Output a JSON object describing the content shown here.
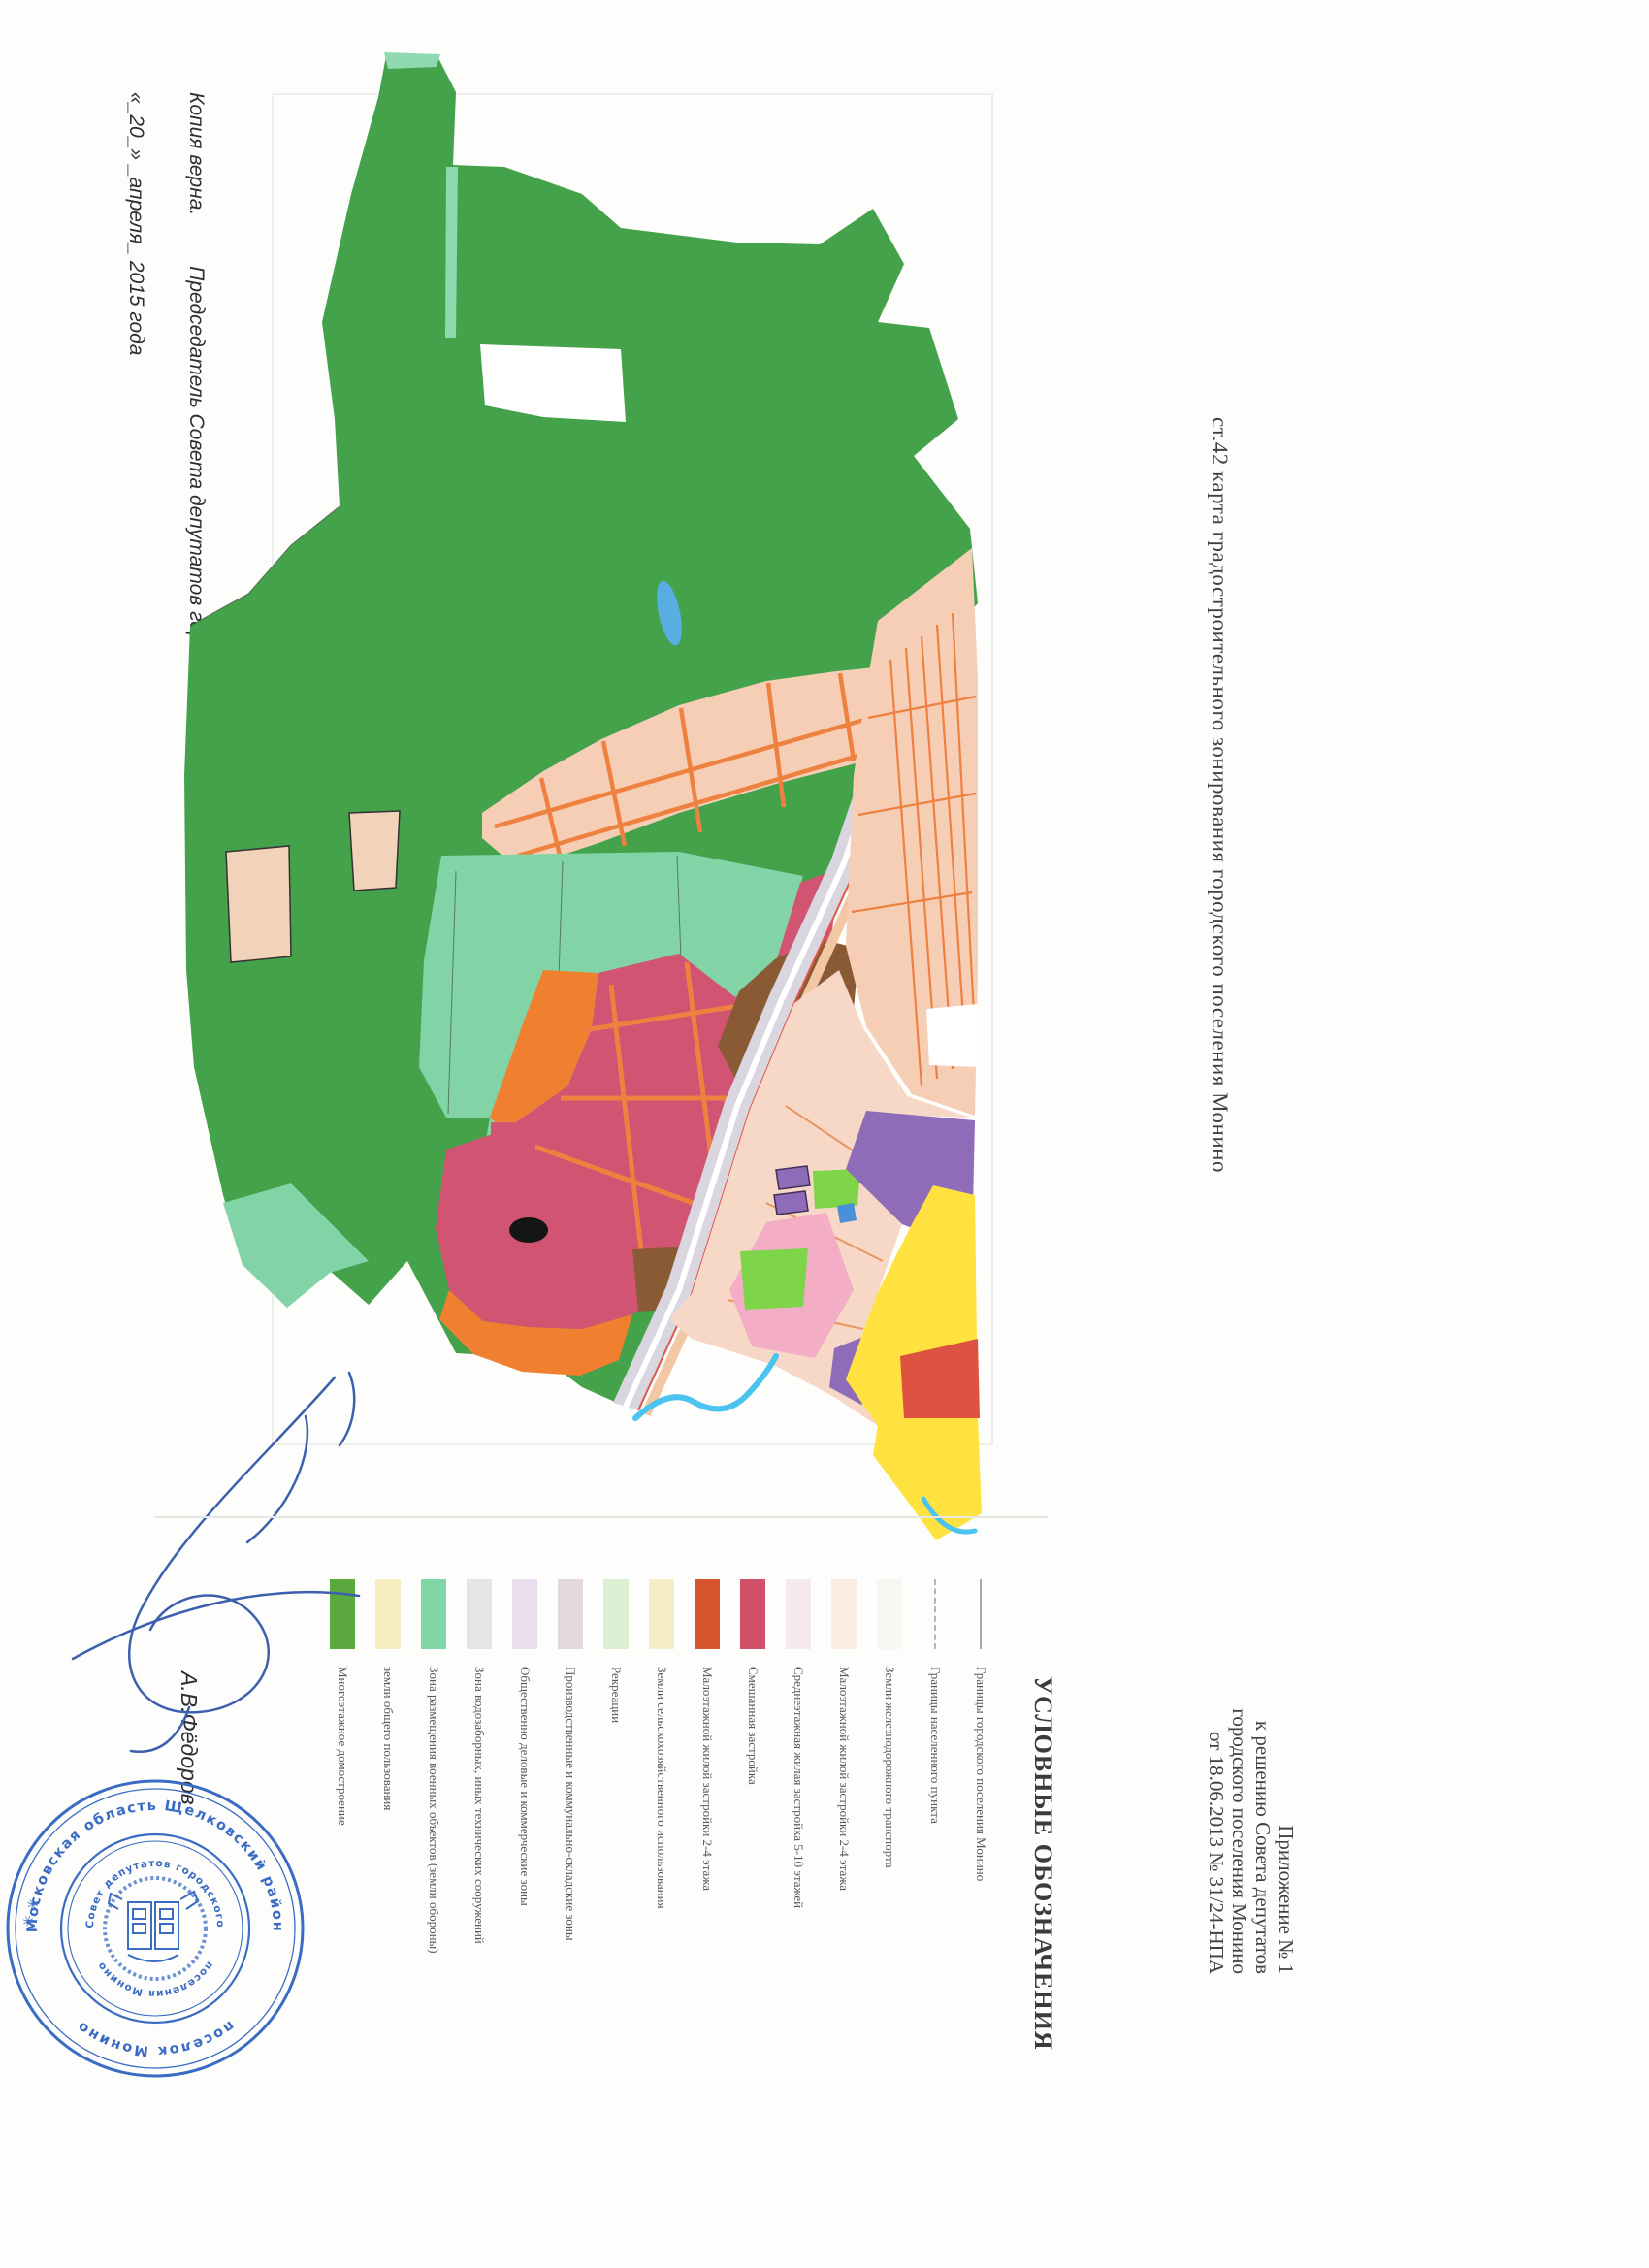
{
  "page": {
    "appendix": {
      "lines": [
        "Приложение № 1",
        "к решению Совета депутатов",
        "городского поселения Монино",
        "от 18.06.2013 № 31/24-НПА"
      ]
    },
    "map_title": "ст.42 карта градостроительного зонирования городского поселения Монино",
    "legend": {
      "title": "УСЛОВНЫЕ ОБОЗНАЧЕНИЯ",
      "items": [
        {
          "label": "Границы городского поселения Монино",
          "symbol": "boundary-line",
          "color": null
        },
        {
          "label": "Границы населенного пункта",
          "symbol": "boundary-dashed",
          "color": null
        },
        {
          "label": "Земли железнодорожного транспорта",
          "symbol": "swatch",
          "color": "#f7f6f3"
        },
        {
          "label": "Малоэтажной жилой застройки 2-4 этажа",
          "symbol": "swatch",
          "color": "#fbece4"
        },
        {
          "label": "Среднеэтажная жилая застройка 5-10 этажей",
          "symbol": "swatch",
          "color": "#f5e9ee"
        },
        {
          "label": "Смешанная застройка",
          "symbol": "swatch",
          "color": "#d05168"
        },
        {
          "label": "Малоэтажной жилой застройки 2-4 этажа",
          "symbol": "swatch",
          "color": "#d8542e"
        },
        {
          "label": "Земли сельскохозяйственного использования",
          "symbol": "swatch",
          "color": "#f5edc6"
        },
        {
          "label": "Рекреации",
          "symbol": "swatch",
          "color": "#dcefd2"
        },
        {
          "label": "Производственные и коммунально-складские зоны",
          "symbol": "swatch",
          "color": "#e5d8dc"
        },
        {
          "label": "Общественно деловые и коммерческие зоны",
          "symbol": "swatch",
          "color": "#e8deec"
        },
        {
          "label": "Зона водозаборных, иных технических сооружений",
          "symbol": "swatch",
          "color": "#e4e5e7"
        },
        {
          "label": "Зона размещения военных объектов (земли обороны)",
          "symbol": "swatch",
          "color": "#82d6a6"
        },
        {
          "label": "земли общего пользования",
          "symbol": "swatch",
          "color": "#f6ecbf"
        },
        {
          "label": "Многоэтажное домостроение",
          "symbol": "swatch",
          "color": "#5aa83e"
        }
      ]
    },
    "certification": {
      "copy_note": "Копия верна.",
      "position": "Председатель Совета депутатов городского поселения Монино",
      "date": "«_20_» _апреля_ 2015 года",
      "name": "А.В.Фёдоров"
    },
    "stamp": {
      "outer_top": "Московская область Щелковский район",
      "outer_bottom": "поселок Монино",
      "inner_top": "Совет депутатов городского",
      "inner_bottom": "поселения Монино",
      "stars": "✳ ✳",
      "color": "#3a6cc4"
    },
    "signature_ink": "#3c5fae",
    "map": {
      "colors": {
        "forest": "#43a24a",
        "seagreen": "#82d4a6",
        "seagreen_light": "#8fd8b0",
        "peach": "#f6ceb6",
        "street": "#ee8040",
        "crimson": "#d15472",
        "orange": "#f08030",
        "brown": "#8a5a35",
        "rail": "#d9d6e0",
        "pink": "#f3aec6",
        "purple": "#8f6cb8",
        "yellow": "#ffe23f",
        "bright_green": "#7fd549",
        "red": "#dd5240",
        "lake": "#58aee0",
        "river": "#4ac3ee",
        "tan": "#f2d2b8",
        "light_pink": "#f7d7c6",
        "white": "#ffffff",
        "black": "#151515"
      }
    }
  }
}
